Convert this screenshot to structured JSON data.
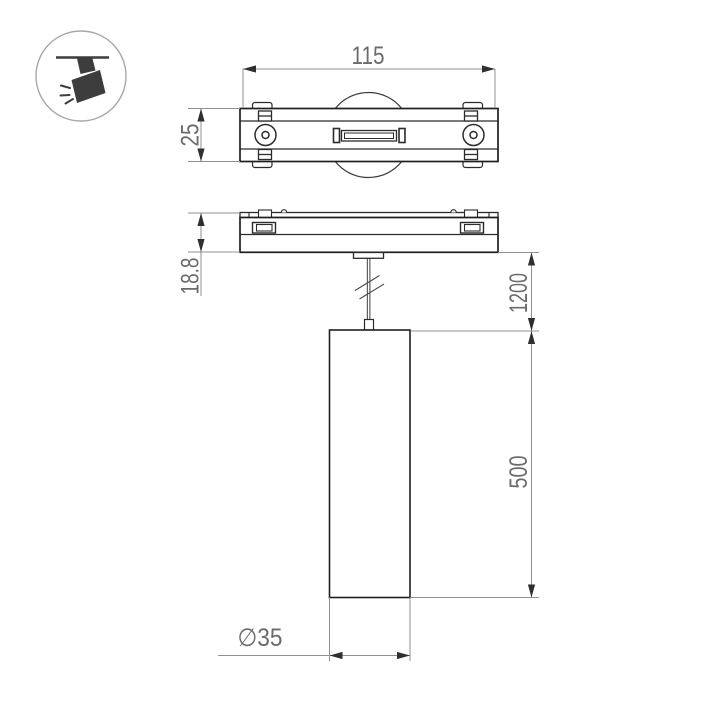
{
  "icon": "track-spotlight",
  "dims": {
    "track_length": "115",
    "track_width": "25",
    "base_height": "18.8",
    "suspension_length": "1200",
    "lamp_height": "500",
    "lamp_diameter": "∅35"
  },
  "colors": {
    "outline": "#222222",
    "detail": "#333333",
    "dimension_line": "#909090",
    "arrow": "#2f2f2f",
    "text": "#6b6b6b",
    "icon_fill": "#3d3d3d",
    "icon_circle": "#a8a8a8",
    "background": "#ffffff"
  }
}
